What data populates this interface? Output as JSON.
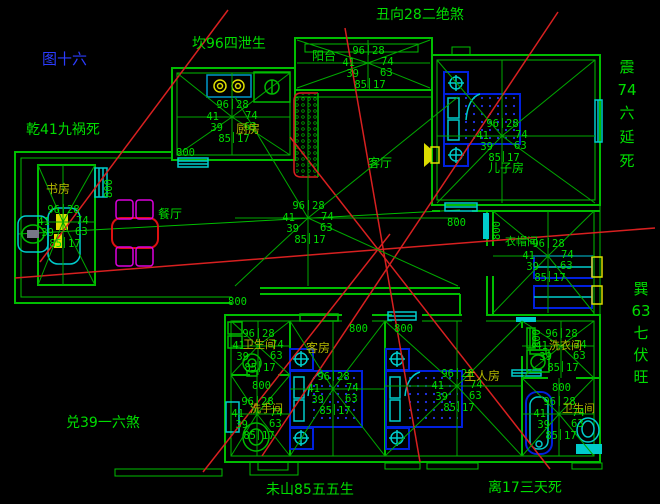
{
  "colors": {
    "background": "#000000",
    "wall_green": "#00be00",
    "text_green": "#00dd00",
    "label_olive": "#b4b800",
    "title_blue": "#2b3cff",
    "sightline_red": "#d82020",
    "furniture_blue": "#0020dd",
    "fixture_cyan": "#00cccc",
    "accent_yellow": "#dddd00",
    "chair_magenta": "#dd00dd"
  },
  "compass": {
    "figure_number": "图十六",
    "top_left": "坎96四泄生",
    "top": "丑向28二绝煞",
    "left": "乾41九祸死",
    "bottom_left": "兑39一六煞",
    "bottom_center": "未山85五五生",
    "bottom_right": "离17三天死",
    "right_upper": {
      "rows": [
        "震",
        "74",
        "六",
        "延",
        "死"
      ]
    },
    "right_lower": {
      "rows": [
        "巽",
        "63",
        "七",
        "伏",
        "旺"
      ]
    }
  },
  "rooms": {
    "kitchen": {
      "label": "厨房"
    },
    "study": {
      "label": "书房"
    },
    "dining": {
      "label": "餐厅"
    },
    "balcony": {
      "label": "阳台"
    },
    "living": {
      "label": "客厅"
    },
    "son": {
      "label": "儿子房"
    },
    "closet": {
      "label": "衣帽间"
    },
    "bath_a": {
      "label": "卫生间"
    },
    "bath_b": {
      "label": "洗手间"
    },
    "guest": {
      "label": "客房"
    },
    "master": {
      "label": "主人房"
    },
    "laundry": {
      "label": "洗衣间"
    },
    "bath_br": {
      "label": "卫生间"
    }
  },
  "doors": {
    "width_label": "800"
  },
  "star_numbers": {
    "top_left": "96",
    "top_right": "28",
    "left": "41",
    "right": "74",
    "lower_left": "39",
    "lower_right": "63",
    "bottom_left": "85",
    "bottom_right": "17"
  },
  "stars": [
    {
      "room": "kitchen",
      "cx": 232,
      "cy": 117,
      "x1": 177,
      "y1": 73,
      "x2": 290,
      "y2": 155
    },
    {
      "room": "study",
      "cx": 63,
      "cy": 222,
      "x1": 38,
      "y1": 165,
      "x2": 95,
      "y2": 285
    },
    {
      "room": "living",
      "cx": 308,
      "cy": 218,
      "x1": 235,
      "y1": 97,
      "x2": 458,
      "y2": 286
    },
    {
      "room": "balcony",
      "cx": 368,
      "cy": 63,
      "x1": 297,
      "y1": 40,
      "x2": 430,
      "y2": 88
    },
    {
      "room": "son",
      "cx": 502,
      "cy": 136,
      "x1": 437,
      "y1": 60,
      "x2": 595,
      "y2": 203
    },
    {
      "room": "closet",
      "cx": 548,
      "cy": 256,
      "x1": 493,
      "y1": 211,
      "x2": 594,
      "y2": 313
    },
    {
      "room": "bath_a",
      "cx": 258,
      "cy": 346,
      "x1": 231,
      "y1": 321,
      "x2": 290,
      "y2": 375
    },
    {
      "room": "bath_b",
      "cx": 257,
      "cy": 414,
      "x1": 231,
      "y1": 375,
      "x2": 290,
      "y2": 456
    },
    {
      "room": "guest",
      "cx": 333,
      "cy": 389,
      "x1": 290,
      "y1": 321,
      "x2": 385,
      "y2": 456
    },
    {
      "room": "master",
      "cx": 457,
      "cy": 386,
      "x1": 385,
      "y1": 321,
      "x2": 522,
      "y2": 456
    },
    {
      "room": "laundry",
      "cx": 561,
      "cy": 346,
      "x1": 522,
      "y1": 321,
      "x2": 594,
      "y2": 378
    },
    {
      "room": "bath_br",
      "cx": 559,
      "cy": 414,
      "x1": 522,
      "y1": 378,
      "x2": 594,
      "y2": 456
    }
  ]
}
